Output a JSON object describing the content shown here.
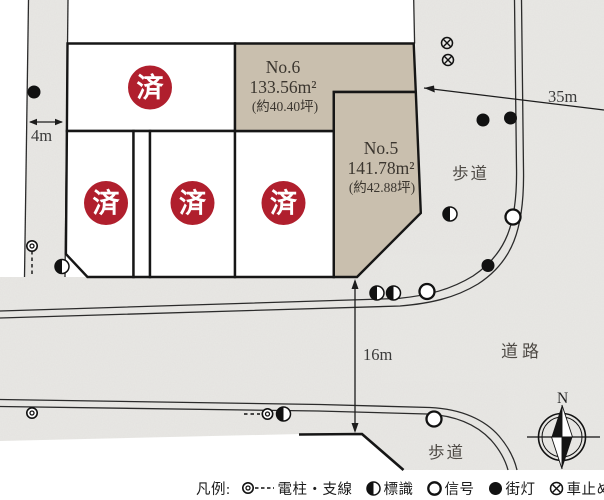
{
  "map": {
    "sold_label": "済",
    "lots": {
      "no6": {
        "name": "No.6",
        "area": "133.56m²",
        "tsubo": "(約40.40坪)"
      },
      "no5": {
        "name": "No.5",
        "area": "141.78m²",
        "tsubo": "(約42.88坪)"
      }
    },
    "labels": {
      "sidewalk_right": "歩道",
      "sidewalk_bottom": "歩道",
      "road": "道路",
      "compass_north": "N"
    },
    "dimensions": {
      "west_road_width": "4m",
      "east_length": "35m",
      "south_road_width": "16m"
    }
  },
  "legend": {
    "prefix": "凡例:",
    "items": [
      {
        "icon": "utility-pole-icon",
        "label": "電柱・支線"
      },
      {
        "icon": "sign-icon",
        "label": "標識"
      },
      {
        "icon": "signal-icon",
        "label": "信号"
      },
      {
        "icon": "streetlight-icon",
        "label": "街灯"
      },
      {
        "icon": "car-stop-icon",
        "label": "車止め"
      }
    ]
  },
  "colors": {
    "road": "#e9e8e5",
    "lot_available": "#c9bfae",
    "sold_badge": "#b01f2d",
    "line": "#161616"
  }
}
